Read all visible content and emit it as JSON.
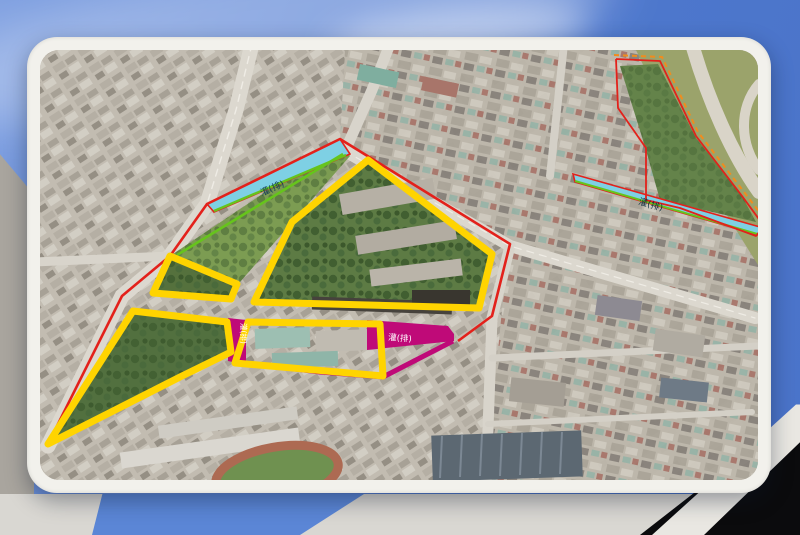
{
  "map": {
    "labels": {
      "west_channel": "灌(排)",
      "east_channel": "灌(排)",
      "south_channel": "灌(排)",
      "cross_channel": "灌(排)"
    }
  },
  "colors": {
    "boundary_yellow": "#ffd400",
    "boundary_red": "#e3211b",
    "boundary_magenta": "#bf0a78",
    "channel_cyan": "#7ed0e4",
    "boundary_green": "#66c41c",
    "boundary_orange": "#f08c1e",
    "frame_white": "#f2f1ec",
    "sky_blue": "#4f7ccf"
  }
}
